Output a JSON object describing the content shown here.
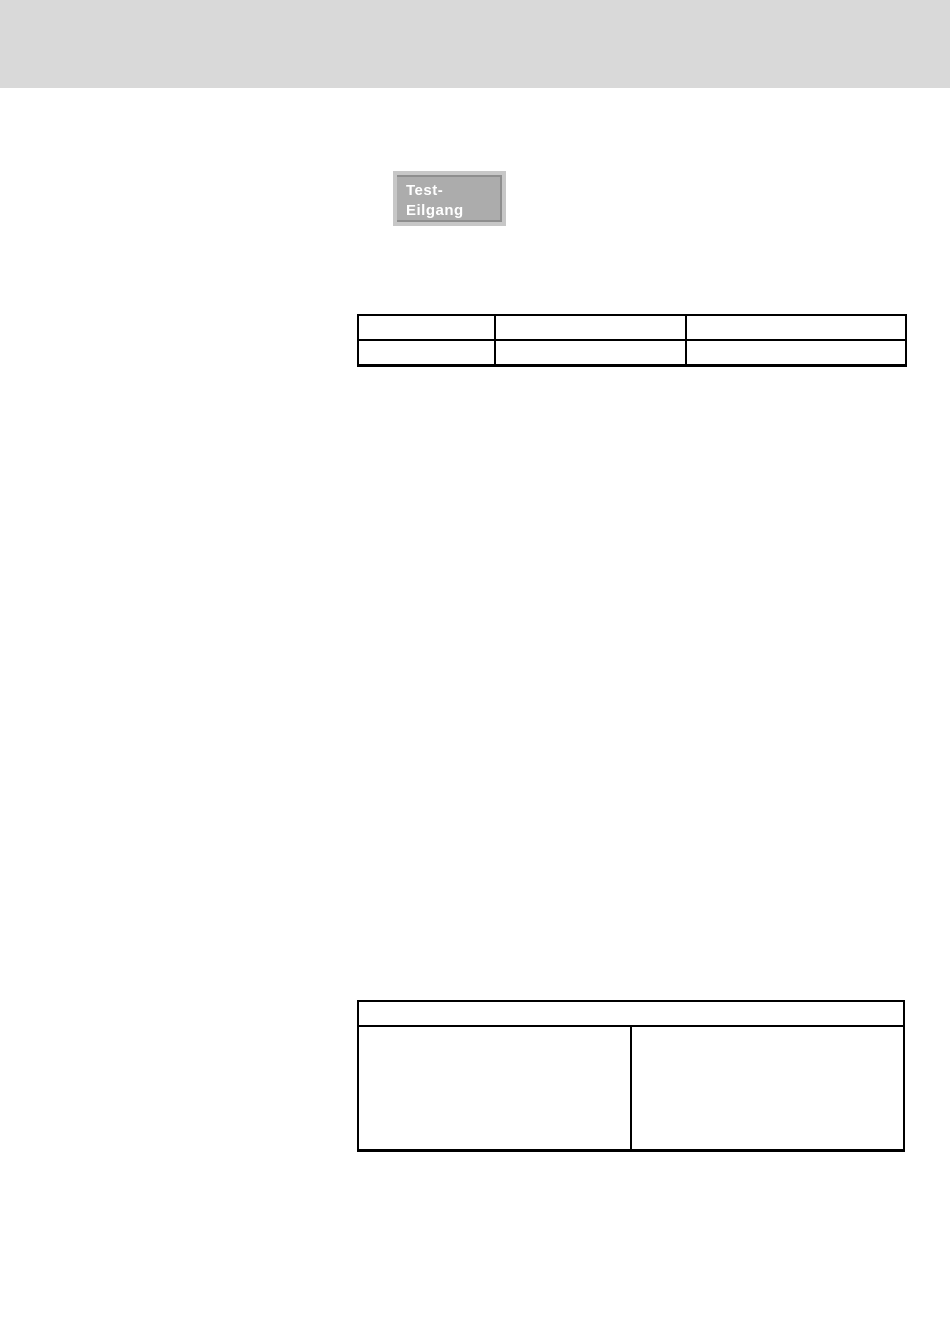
{
  "page": {
    "background_color": "#ffffff",
    "top_bar_color": "#d9d9d9"
  },
  "test_button": {
    "label_line1": "Test-",
    "label_line2": "Eilgang",
    "face_color": "#acacac",
    "frame_color": "#c7c7c7",
    "edge_color": "#8e8e8e",
    "text_color": "#ffffff"
  },
  "parameter_table": {
    "border_color": "#000000",
    "rows": [
      [
        "",
        "",
        ""
      ],
      [
        "",
        "",
        ""
      ]
    ]
  },
  "info_table": {
    "border_color": "#000000",
    "header_cell": "",
    "body_cells": [
      "",
      ""
    ]
  }
}
